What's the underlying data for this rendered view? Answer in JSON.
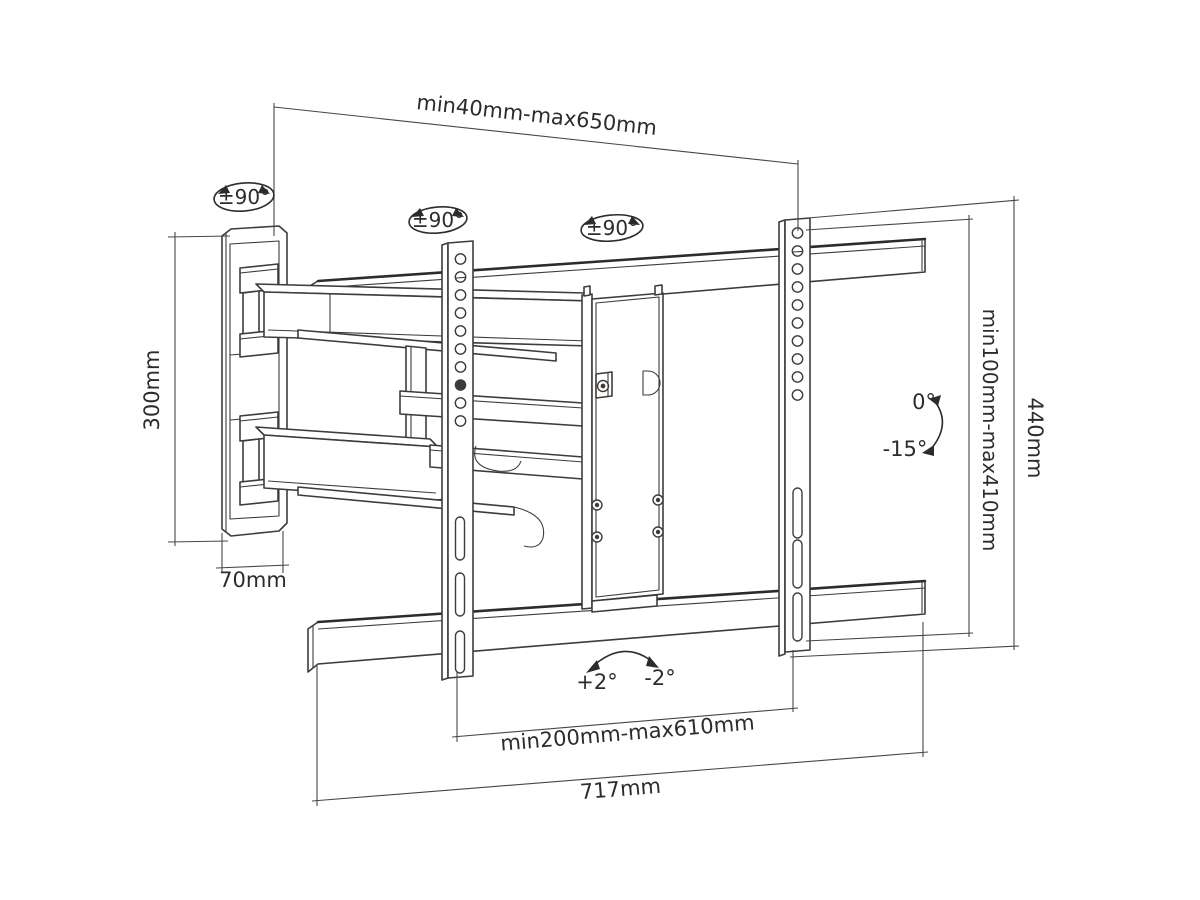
{
  "drawing": {
    "type": "technical-line-drawing",
    "subject": "full-motion TV wall mount bracket, perspective view with dimensions",
    "background_color": "#ffffff",
    "line_color": "#3f3b39",
    "text_color": "#2e2b29"
  },
  "labels": {
    "top_span": "min40mm-max650mm",
    "swivel_left": "±90°",
    "swivel_mid": "±90°",
    "swivel_right": "±90°",
    "plate_height": "300mm",
    "plate_width": "70mm",
    "tilt_zero": "0°",
    "tilt_down": "-15°",
    "rail_span": "min100mm-max410mm",
    "bracket_height": "440mm",
    "level_plus": "+2°",
    "level_minus": "-2°",
    "bottom_span": "min200mm-max610mm",
    "bracket_width": "717mm"
  }
}
